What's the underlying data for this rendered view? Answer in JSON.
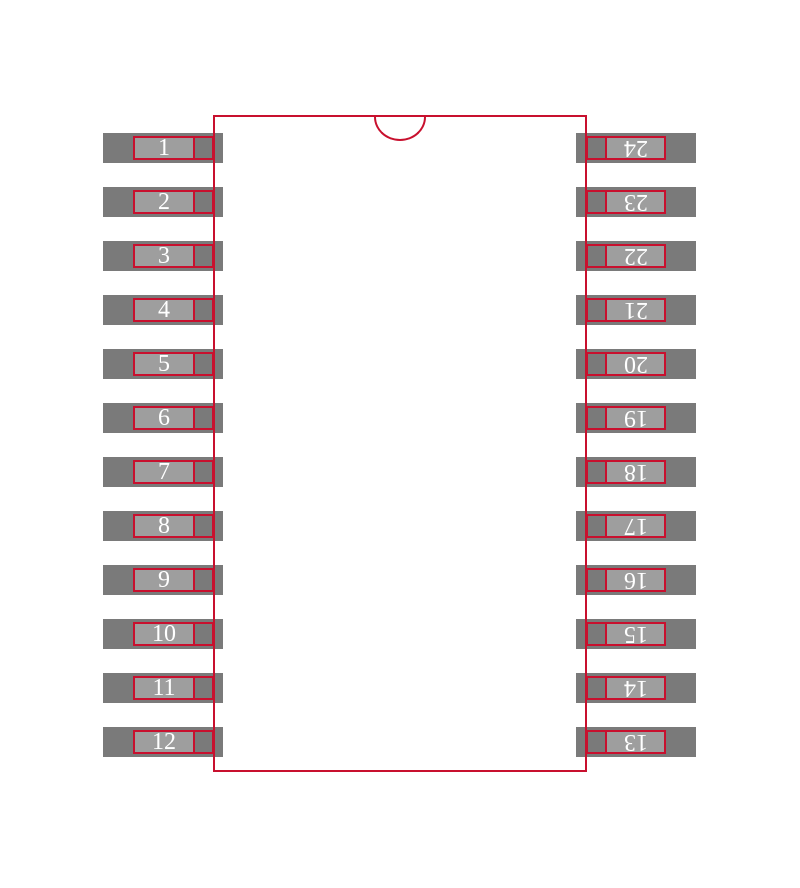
{
  "pins": {
    "left": [
      "1",
      "2",
      "3",
      "4",
      "5",
      "6",
      "7",
      "8",
      "9",
      "10",
      "11",
      "12"
    ],
    "right": [
      "24",
      "23",
      "22",
      "21",
      "20",
      "19",
      "18",
      "17",
      "16",
      "15",
      "14",
      "13"
    ]
  },
  "colors": {
    "outline": "#C8102E",
    "pad_fill": "#7A7A7A",
    "lead_fill": "#9E9E9E",
    "pin_number_text": "#FFFFFF",
    "background": "#FFFFFF"
  }
}
